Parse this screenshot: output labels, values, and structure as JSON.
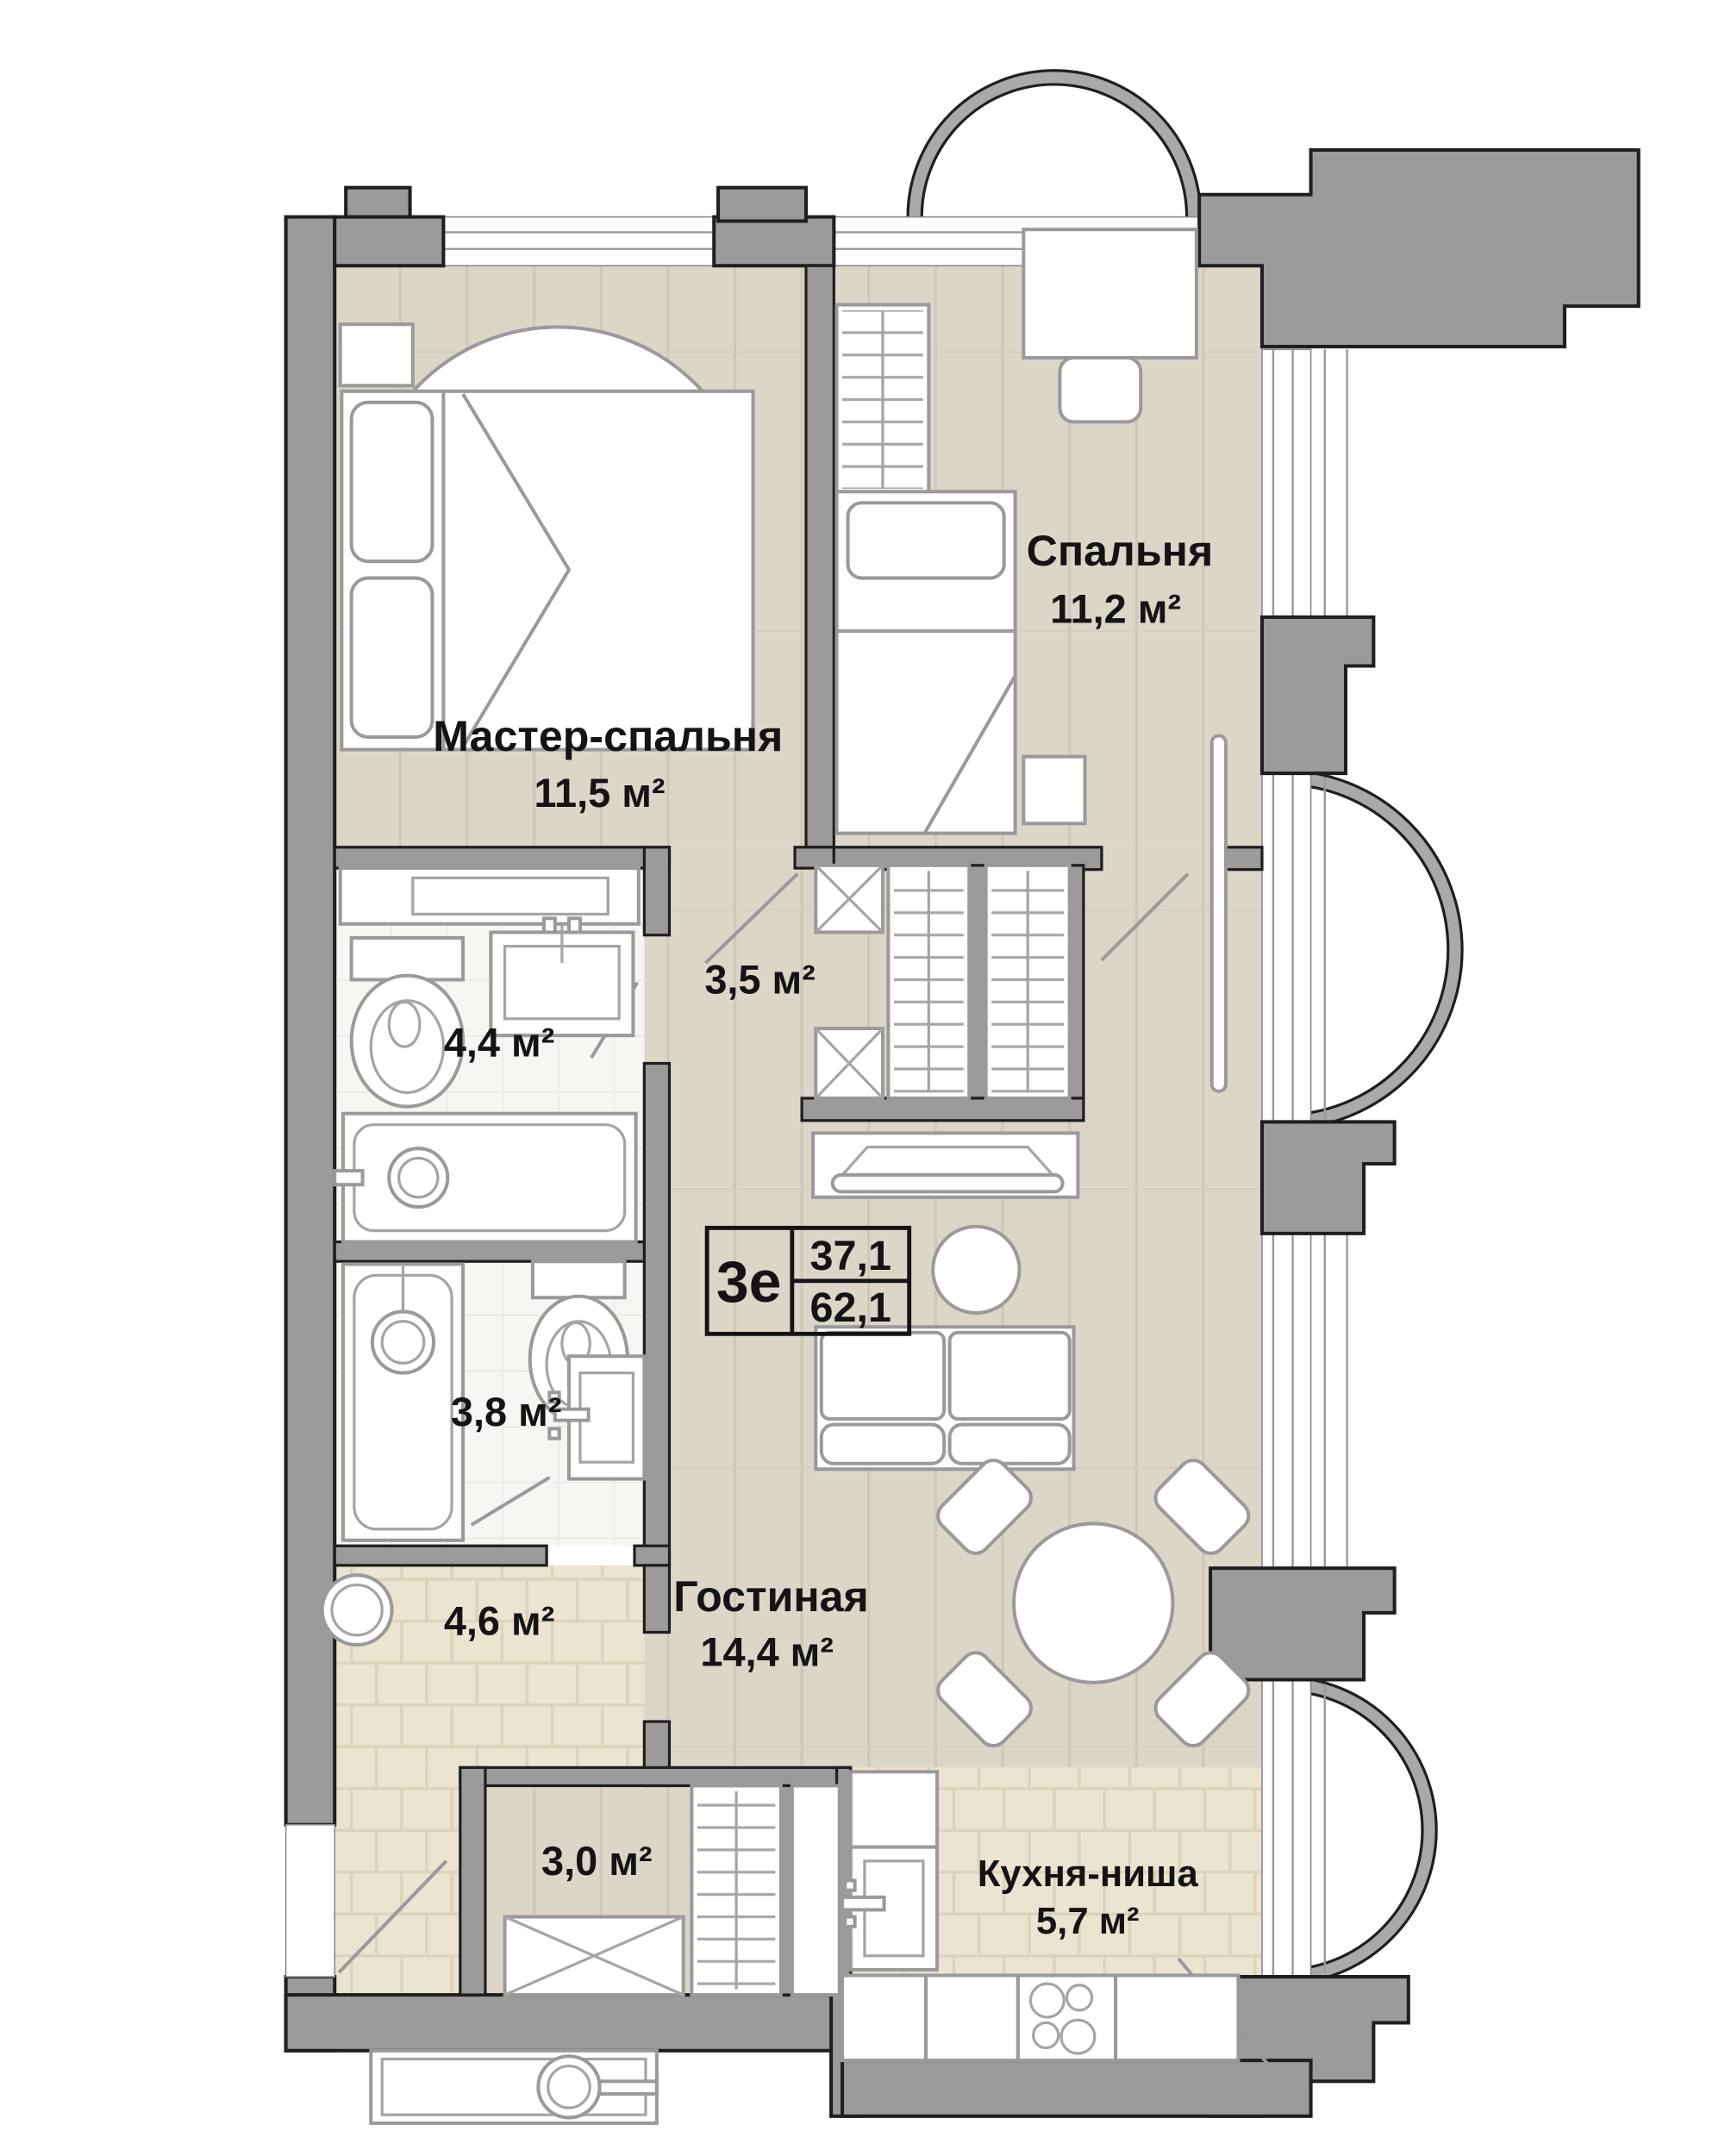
{
  "plan": {
    "info_box": {
      "unit": "3е",
      "upper_area": "37,1",
      "lower_area": "62,1"
    },
    "rooms": {
      "master": {
        "name": "Мастер-спальня",
        "area": "11,5 м²"
      },
      "bedroom": {
        "name": "Спальня",
        "area": "11,2 м²"
      },
      "corridor": {
        "area": "3,5 м²"
      },
      "bath_large": {
        "area": "4,4 м²"
      },
      "bath_small": {
        "area": "3,8 м²"
      },
      "hall": {
        "area": "4,6 м²"
      },
      "wardrobe": {
        "area": "3,0 м²"
      },
      "living": {
        "name": "Гостиная",
        "area": "14,4 м²"
      },
      "kitchen": {
        "name": "Кухня-ниша",
        "area": "5,7 м²"
      }
    },
    "colors": {
      "wall": "#9b9b9b",
      "wood_floor": "#dcd6c9",
      "bath_tile": "#f7f6f3",
      "beige_tile": "#ebe4d1",
      "furniture_line": "#9a9a9a",
      "outline": "#1f1f1f"
    }
  }
}
